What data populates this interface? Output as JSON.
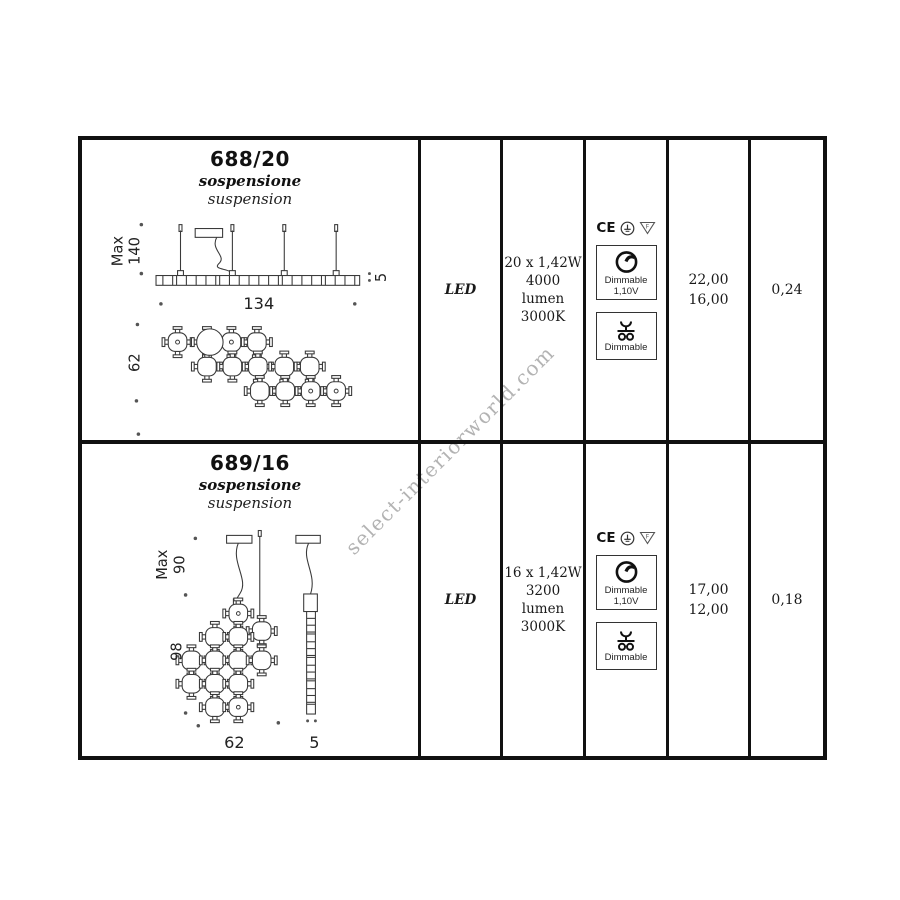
{
  "watermark": "select-interiorworld.com",
  "colors": {
    "border": "#111111",
    "line": "#3a3a3a",
    "text": "#1a1a1a",
    "watermark": "#b3b3b3"
  },
  "table": {
    "rows": [
      {
        "model": "688/20",
        "type_it": "sospensione",
        "type_en": "suspension",
        "light_source": "LED",
        "specs": [
          "20 x 1,42W",
          "4000 lumen",
          "3000K"
        ],
        "certifications": {
          "ce": "CE",
          "f_mark": "F"
        },
        "dimmer_box": {
          "label": "Dimmable",
          "voltage": "1,10V"
        },
        "push_dim_box": {
          "label": "Dimmable"
        },
        "prices": [
          "22,00",
          "16,00"
        ],
        "volume": "0,24",
        "dimensions": {
          "max_label": "Max",
          "max_height": "140",
          "width": "134",
          "depth": "5",
          "fixture_height": "62"
        }
      },
      {
        "model": "689/16",
        "type_it": "sospensione",
        "type_en": "suspension",
        "light_source": "LED",
        "specs": [
          "16 x 1,42W",
          "3200 lumen",
          "3000K"
        ],
        "certifications": {
          "ce": "CE",
          "f_mark": "F"
        },
        "dimmer_box": {
          "label": "Dimmable",
          "voltage": "1,10V"
        },
        "push_dim_box": {
          "label": "Dimmable"
        },
        "prices": [
          "17,00",
          "12,00"
        ],
        "volume": "0,18",
        "dimensions": {
          "max_label": "Max",
          "max_height": "90",
          "fixture_height": "98",
          "width": "62",
          "depth": "5"
        }
      }
    ]
  }
}
